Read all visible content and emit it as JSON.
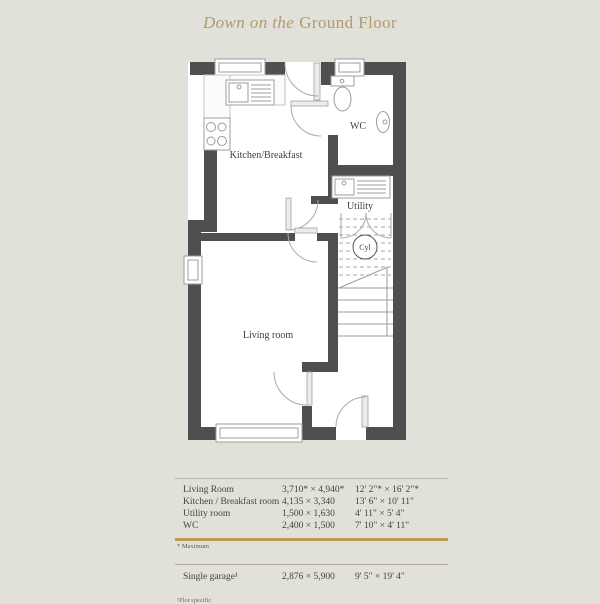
{
  "title": {
    "italic": "Down on the",
    "regular": "Ground Floor"
  },
  "plan": {
    "rooms": {
      "kitchen": "Kitchen/Breakfast",
      "wc": "WC",
      "utility": "Utility",
      "cyl": "Cyl",
      "living": "Living room"
    }
  },
  "table": {
    "rows": [
      {
        "name": "Living Room",
        "metric": "3,710* × 4,940*",
        "imperial": "12' 2\"* × 16' 2\"*"
      },
      {
        "name": "Kitchen / Breakfast room",
        "metric": "4,135 × 3,340",
        "imperial": "13' 6\" × 10' 11\""
      },
      {
        "name": "Utility room",
        "metric": "1,500 × 1,630",
        "imperial": "4' 11\" × 5' 4\""
      },
      {
        "name": "WC",
        "metric": "2,400 × 1,500",
        "imperial": "7' 10\" × 4' 11\""
      }
    ],
    "footnote_max": "* Maximum",
    "garage": {
      "name": "Single garage¹",
      "metric": "2,876 × 5,900",
      "imperial": "9' 5\" × 19' 4\""
    },
    "footnote_plot": "¹Plot specific"
  },
  "colors": {
    "background": "#e1e1da",
    "wall": "#4f4f4f",
    "accent_tan": "#bf9757",
    "title_tan": "#b09a6f",
    "text": "#43453c"
  }
}
